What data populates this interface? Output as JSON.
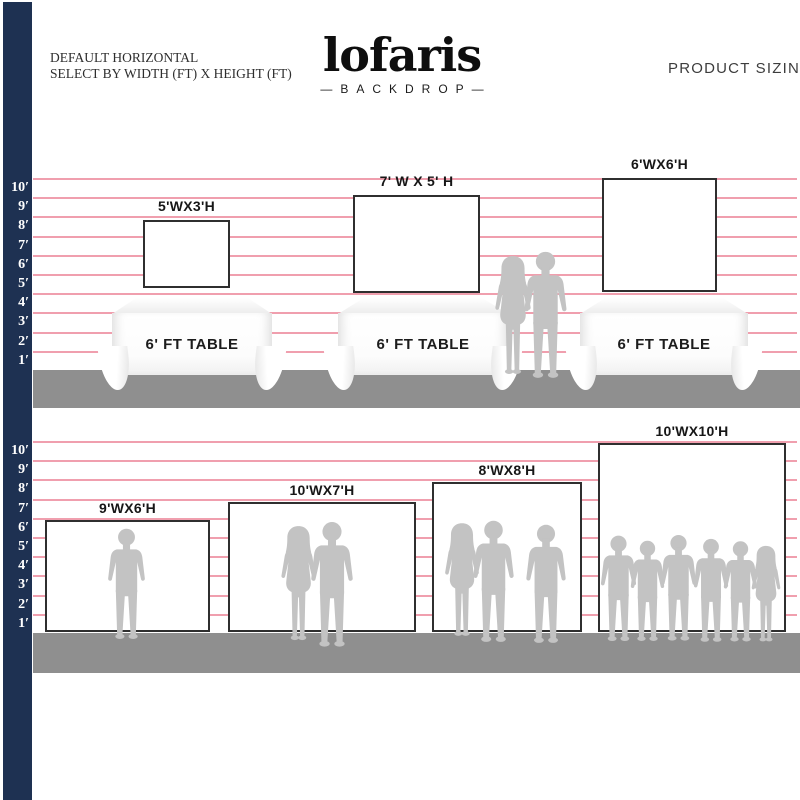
{
  "header": {
    "instruction_line1": "DEFAULT HORIZONTAL",
    "instruction_line2": "SELECT BY WIDTH (FT) X HEIGHT (FT)",
    "right_title": "PRODUCT SIZING"
  },
  "logo": {
    "name": "lofaris",
    "subtitle": "—BACKDROP—"
  },
  "ruler_labels": [
    "10′",
    "9′",
    "8′",
    "7′",
    "6′",
    "5′",
    "4′",
    "3′",
    "2′",
    "1′"
  ],
  "top_section": {
    "backdrops": [
      {
        "label": "5'WX3'H",
        "width_ft": 5,
        "height_ft": 3
      },
      {
        "label": "7' W X 5' H",
        "width_ft": 7,
        "height_ft": 5
      },
      {
        "label": "6'WX6'H",
        "width_ft": 6,
        "height_ft": 6
      }
    ],
    "tables": [
      {
        "label": "6' FT TABLE"
      },
      {
        "label": "6' FT TABLE"
      },
      {
        "label": "6' FT TABLE"
      }
    ],
    "figures": [
      "woman-silhouette-icon",
      "man-silhouette-icon"
    ]
  },
  "bottom_section": {
    "backdrops": [
      {
        "label": "9'WX6'H",
        "width_ft": 9,
        "height_ft": 6,
        "figures": [
          "man-silhouette-icon"
        ]
      },
      {
        "label": "10'WX7'H",
        "width_ft": 10,
        "height_ft": 7,
        "figures": [
          "woman-silhouette-icon",
          "man-silhouette-icon"
        ]
      },
      {
        "label": "8'WX8'H",
        "width_ft": 8,
        "height_ft": 8,
        "figures": [
          "woman-silhouette-icon",
          "man-silhouette-icon",
          "man-silhouette-icon"
        ]
      },
      {
        "label": "10'WX10'H",
        "width_ft": 10,
        "height_ft": 10,
        "figures": [
          "man-silhouette-icon",
          "man-silhouette-icon",
          "man-silhouette-icon",
          "man-silhouette-icon",
          "man-silhouette-icon",
          "woman-silhouette-icon"
        ]
      }
    ]
  },
  "colors": {
    "navy_bar": "#1e3152",
    "foot_line_pink": "#f09fae",
    "floor_gray": "#8f8f8f",
    "silhouette_gray": "#c3c3c3",
    "backdrop_border": "#2f2f2f"
  }
}
